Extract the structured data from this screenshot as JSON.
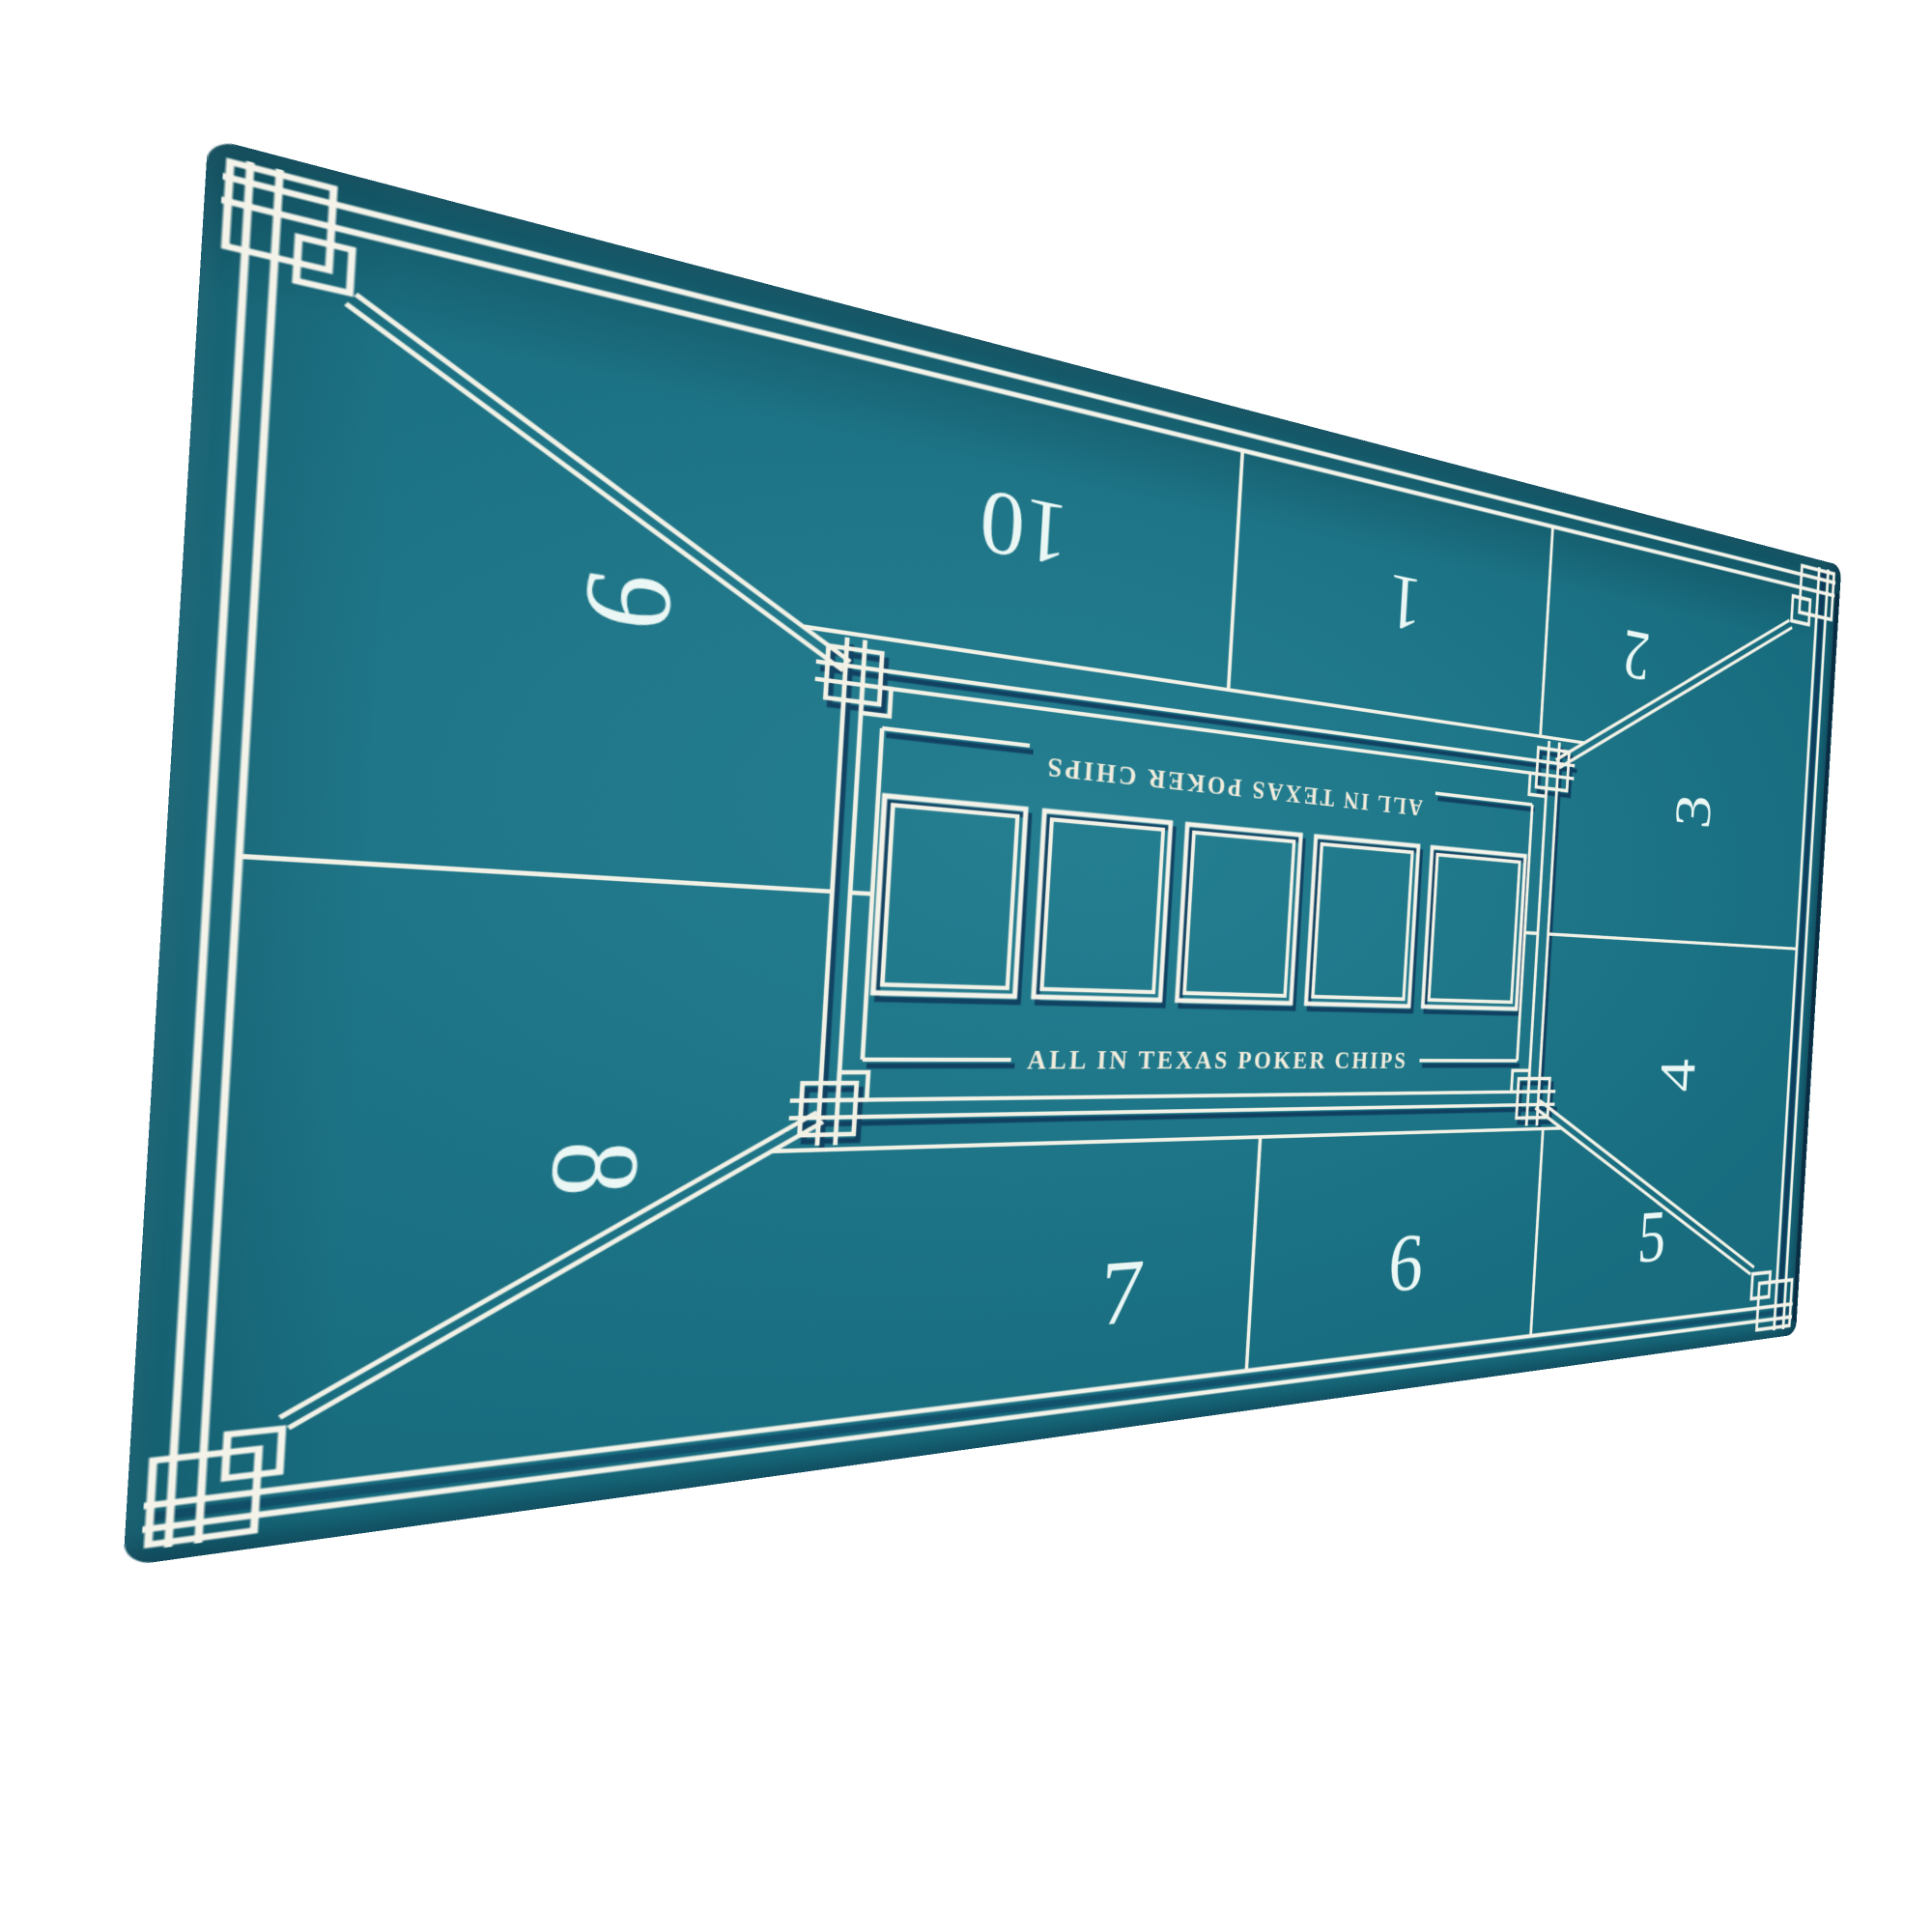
{
  "page": {
    "background_color": "#ffffff",
    "description": "Product photo of a teal 10-seat Texas Hold'em poker table layout mat viewed at an angle"
  },
  "mat": {
    "felt_color": "#17697b",
    "line_color": "#f4f3ea",
    "shadow_color": "#0b2d52",
    "branding": {
      "top_line": "ALL IN TEXAS POKER CHIPS",
      "bottom_line": "ALL IN TEXAS POKER CHIPS"
    },
    "seats": [
      "1",
      "2",
      "3",
      "4",
      "5",
      "6",
      "7",
      "8",
      "9",
      "10"
    ],
    "community_card_slots": 5
  }
}
